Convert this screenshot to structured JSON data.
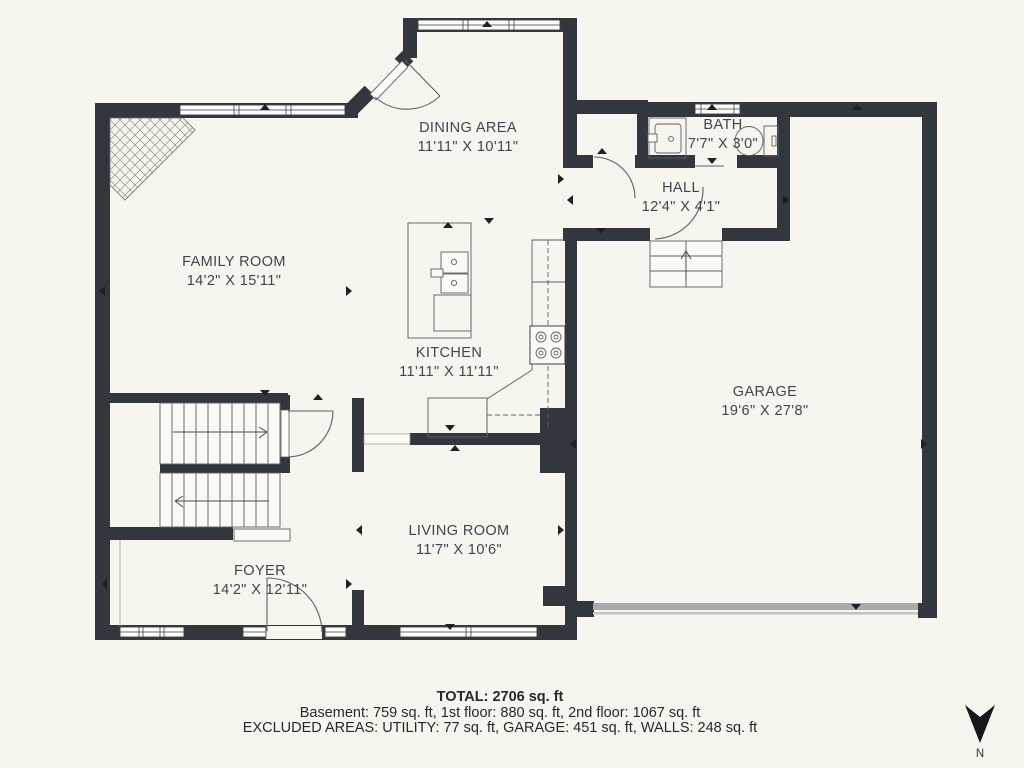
{
  "floorplan": {
    "rooms": {
      "dining": {
        "name": "DINING AREA",
        "dims": "11'11\" X 10'11\""
      },
      "bath": {
        "name": "BATH",
        "dims": "7'7\" X 3'0\""
      },
      "hall": {
        "name": "HALL",
        "dims": "12'4\" X 4'1\""
      },
      "family": {
        "name": "FAMILY ROOM",
        "dims": "14'2\" X 15'11\""
      },
      "kitchen": {
        "name": "KITCHEN",
        "dims": "11'11\" X 11'11\""
      },
      "garage": {
        "name": "GARAGE",
        "dims": "19'6\" X 27'8\""
      },
      "living": {
        "name": "LIVING ROOM",
        "dims": "11'7\" X 10'6\""
      },
      "foyer": {
        "name": "FOYER",
        "dims": "14'2\" X 12'11\""
      }
    },
    "compass": {
      "label": "N",
      "direction": "down"
    }
  },
  "summary": {
    "total": "TOTAL: 2706 sq. ft",
    "floors": "Basement: 759 sq. ft, 1st floor: 880 sq. ft, 2nd floor: 1067 sq. ft",
    "excluded": "EXCLUDED AREAS: UTILITY: 77 sq. ft, GARAGE: 451 sq. ft, WALLS: 248 sq. ft"
  },
  "colors": {
    "wall": "#31373c",
    "bg": "#f6f5ee",
    "line": "#5b6166",
    "text": "#3f464c",
    "footer": "#26292b",
    "garagedoor": "#a9ada9",
    "tick": "#1d2124"
  }
}
